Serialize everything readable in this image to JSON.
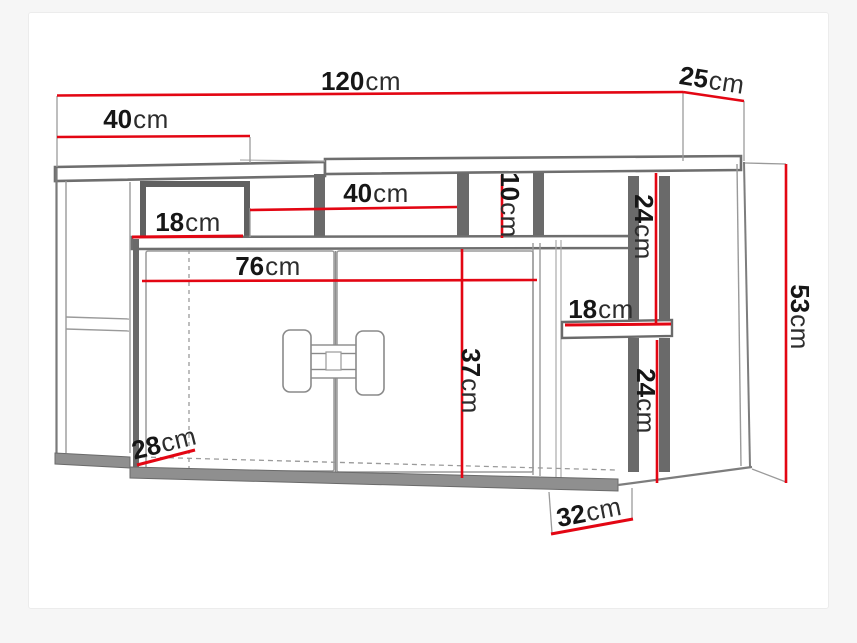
{
  "diagram_title": "wall-cabinet-dimension-drawing",
  "unit_system": "cm",
  "colors": {
    "dimension_red": "#e30613",
    "outline_dark": "#6e6e6e",
    "outline_thin": "#9a9a9a",
    "board_fill": "#8f8f8f",
    "text": "#161616",
    "canvas": "#ffffff",
    "page_background": "#f6f6f6"
  },
  "labels": {
    "total_width": {
      "value": "120",
      "unit": "cm"
    },
    "depth": {
      "value": "25",
      "unit": "cm"
    },
    "top_left_width": {
      "value": "40",
      "unit": "cm"
    },
    "left_niche_width": {
      "value": "18",
      "unit": "cm"
    },
    "middle_niche_width": {
      "value": "40",
      "unit": "cm"
    },
    "right_niche_height": {
      "value": "10",
      "unit": "cm"
    },
    "right_upper_height": {
      "value": "24",
      "unit": "cm"
    },
    "right_shelf_width": {
      "value": "18",
      "unit": "cm"
    },
    "doors_width": {
      "value": "76",
      "unit": "cm"
    },
    "doors_height": {
      "value": "37",
      "unit": "cm"
    },
    "right_lower_height": {
      "value": "24",
      "unit": "cm"
    },
    "total_height": {
      "value": "53",
      "unit": "cm"
    },
    "bottom_left_depth": {
      "value": "28",
      "unit": "cm"
    },
    "bottom_right_depth": {
      "value": "32",
      "unit": "cm"
    }
  }
}
